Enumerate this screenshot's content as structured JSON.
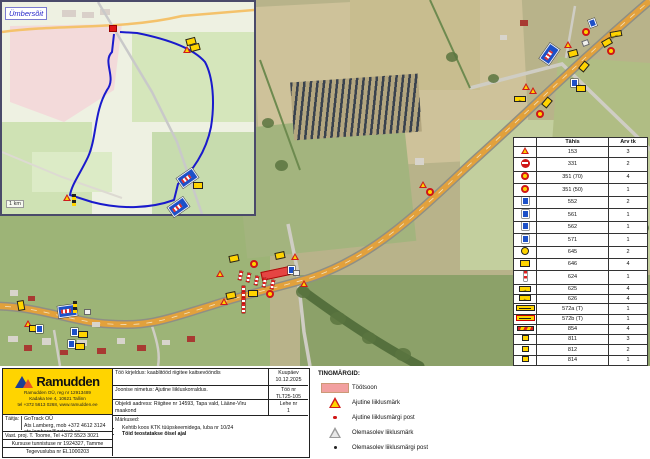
{
  "inset": {
    "label": "Ümbersõit",
    "scale": "1 km"
  },
  "legend_table": {
    "header": {
      "icon": "",
      "code": "Tähis",
      "qty": "Arv tk"
    },
    "rows": [
      {
        "icon": "warn",
        "code": "153",
        "qty": "3"
      },
      {
        "icon": "noentry",
        "code": "331",
        "qty": "2"
      },
      {
        "icon": "speed",
        "code": "351 (70)",
        "qty": "4"
      },
      {
        "icon": "speed",
        "code": "351 (50)",
        "qty": "1"
      },
      {
        "icon": "blueboard",
        "code": "552",
        "qty": "2"
      },
      {
        "icon": "blueboard",
        "code": "561",
        "qty": "1"
      },
      {
        "icon": "blueboard",
        "code": "562",
        "qty": "1"
      },
      {
        "icon": "blueboard",
        "code": "571",
        "qty": "1"
      },
      {
        "icon": "ycircle",
        "code": "645",
        "qty": "2"
      },
      {
        "icon": "yellowboard",
        "code": "646",
        "qty": "4"
      },
      {
        "icon": "delin",
        "code": "624",
        "qty": "1"
      },
      {
        "icon": "arrowR",
        "code": "625",
        "qty": "4"
      },
      {
        "icon": "arrowL",
        "code": "626",
        "qty": "4"
      },
      {
        "icon": "ylong",
        "code": "572a (T)",
        "qty": "1"
      },
      {
        "icon": "ylong2",
        "code": "572b (T)",
        "qty": "1"
      },
      {
        "icon": "fence",
        "code": "854",
        "qty": "4"
      },
      {
        "icon": "ysmall",
        "code": "811",
        "qty": "3"
      },
      {
        "icon": "ysmall",
        "code": "812",
        "qty": "2"
      },
      {
        "icon": "ysmall",
        "code": "814",
        "qty": "1"
      },
      {
        "icon": "ywide",
        "code": "784c Väljasõit\nehitusalalt",
        "qty": "2"
      },
      {
        "icon": "flagred",
        "code": "Post 1,3m",
        "qty": "27"
      },
      {
        "icon": "flagpink",
        "code": "Post 2,3m",
        "qty": "5"
      },
      {
        "icon": "flagblue",
        "code": "Post 3,3m",
        "qty": "2"
      },
      {
        "icon": "lamp",
        "code": "Punane lamp",
        "qty": "4"
      }
    ]
  },
  "symbols_legend": {
    "title": "TINGMÄRGID:",
    "items": [
      {
        "icon": "zone",
        "label": "Töötsoon"
      },
      {
        "icon": "tempsign",
        "label": "Ajutine liiklusmärk"
      },
      {
        "icon": "temppost",
        "label": "Ajutine liiklusmärgi post"
      },
      {
        "icon": "existsign",
        "label": "Olemasolev liiklusmärk"
      },
      {
        "icon": "existpost",
        "label": "Olemasolev liiklusmärgi post"
      }
    ]
  },
  "title_block": {
    "brand": "Ramudden",
    "brand_lines": [
      "Ramudden OÜ, reg nr 12913489",
      "Kadaka tee 4, 10621 Tallinn",
      "tel +372 5613 0268, www.ramudden.ee"
    ],
    "performer_label": "Täitja:",
    "performer_lines": [
      "GoTrack OÜ",
      "Ats Lamberg, mob +372 4612 3124",
      "ats.lamberg@gotrack.ee"
    ],
    "resp_line": "Vast. proj.  T. Toome, Tel +372 5523 3021",
    "cert_line": "Kursuse tunnistuse nr 1924327, Tamme",
    "license_line": "Tegevusluba nr EL1000203",
    "desc": "Töö kirjeldus: kaablitööd riigitee kaitsevööndis",
    "date_label": "Kuupäev",
    "date": "10.12.2025",
    "drawing": "Joonise nimetus: Ajutine liikluskorraldus.",
    "job_label": "Töö nr",
    "job": "TLT25-105",
    "address": "Objekti aadress: Riigitee nr 14593, Tapa vald, Lääne-Viru maakond",
    "sheet_label": "Lehe nr",
    "sheet": "1",
    "notes_title": "Märkused:",
    "notes": [
      {
        "text": "Kehtib koos KTK tüüpskeemidega, luba nr 10/24",
        "bold": false
      },
      {
        "text": "Töid teostatakse öisel ajal",
        "bold": true
      }
    ]
  },
  "map": {
    "colors": {
      "road": "#e2a13c",
      "workzone": "#e84040",
      "detour_route": "#1a1acc"
    },
    "markers": [
      {
        "t": "detour",
        "x": 540,
        "y": 48,
        "r": -55
      },
      {
        "t": "blueboard",
        "x": 589,
        "y": 19,
        "r": -20
      },
      {
        "t": "speed",
        "x": 582,
        "y": 28,
        "r": 0
      },
      {
        "t": "arrowR",
        "x": 610,
        "y": 31,
        "r": -10
      },
      {
        "t": "yellowboard",
        "x": 602,
        "y": 39,
        "r": -30
      },
      {
        "t": "speed",
        "x": 607,
        "y": 47,
        "r": 0
      },
      {
        "t": "warn",
        "x": 564,
        "y": 41,
        "r": 0
      },
      {
        "t": "whiteboard",
        "x": 582,
        "y": 40,
        "r": -20
      },
      {
        "t": "yellowboard",
        "x": 568,
        "y": 50,
        "r": -15
      },
      {
        "t": "yellowboard",
        "x": 579,
        "y": 63,
        "r": -50
      },
      {
        "t": "blueboard",
        "x": 571,
        "y": 79,
        "r": 0
      },
      {
        "t": "yellowboard",
        "x": 576,
        "y": 85,
        "r": 0
      },
      {
        "t": "warn",
        "x": 522,
        "y": 83,
        "r": 0
      },
      {
        "t": "warn",
        "x": 529,
        "y": 87,
        "r": 0
      },
      {
        "t": "arrowL",
        "x": 514,
        "y": 96,
        "r": 0
      },
      {
        "t": "yellowboard",
        "x": 542,
        "y": 99,
        "r": -50
      },
      {
        "t": "speed",
        "x": 536,
        "y": 110,
        "r": 0
      },
      {
        "t": "warn",
        "x": 419,
        "y": 181,
        "r": 0
      },
      {
        "t": "speed",
        "x": 426,
        "y": 188,
        "r": 0
      },
      {
        "t": "post",
        "x": 239,
        "y": 271,
        "r": 12
      },
      {
        "t": "post",
        "x": 247,
        "y": 273,
        "r": 12
      },
      {
        "t": "post",
        "x": 255,
        "y": 276,
        "r": 12
      },
      {
        "t": "post",
        "x": 263,
        "y": 278,
        "r": 12
      },
      {
        "t": "post",
        "x": 271,
        "y": 280,
        "r": 12
      },
      {
        "t": "post",
        "x": 242,
        "y": 286,
        "r": 0
      },
      {
        "t": "post",
        "x": 242,
        "y": 292,
        "r": 0
      },
      {
        "t": "post",
        "x": 242,
        "y": 298,
        "r": 0
      },
      {
        "t": "post",
        "x": 242,
        "y": 304,
        "r": 0
      },
      {
        "t": "warn",
        "x": 216,
        "y": 270,
        "r": 0
      },
      {
        "t": "warn",
        "x": 291,
        "y": 253,
        "r": 0
      },
      {
        "t": "warn",
        "x": 300,
        "y": 280,
        "r": 0
      },
      {
        "t": "warn",
        "x": 220,
        "y": 298,
        "r": 0
      },
      {
        "t": "speed",
        "x": 250,
        "y": 260,
        "r": 0
      },
      {
        "t": "speed",
        "x": 266,
        "y": 290,
        "r": 0
      },
      {
        "t": "yellowboard",
        "x": 229,
        "y": 255,
        "r": -12
      },
      {
        "t": "yellowboard",
        "x": 275,
        "y": 252,
        "r": -12
      },
      {
        "t": "yellowboard",
        "x": 226,
        "y": 292,
        "r": -12
      },
      {
        "t": "yellowboard",
        "x": 248,
        "y": 290,
        "r": 0
      },
      {
        "t": "blueboard",
        "x": 288,
        "y": 266,
        "r": 0
      },
      {
        "t": "whiteboard",
        "x": 293,
        "y": 270,
        "r": 0
      },
      {
        "t": "yellowboard",
        "x": 16,
        "y": 302,
        "r": 80
      },
      {
        "t": "warn",
        "x": 24,
        "y": 320,
        "r": 0
      },
      {
        "t": "yellowboard",
        "x": 29,
        "y": 325,
        "r": 0
      },
      {
        "t": "blueboard",
        "x": 36,
        "y": 325,
        "r": 0
      },
      {
        "t": "detour",
        "x": 58,
        "y": 305,
        "r": -8
      },
      {
        "t": "postB",
        "x": 73,
        "y": 301,
        "r": 0
      },
      {
        "t": "whiteboard",
        "x": 84,
        "y": 309,
        "r": 0
      },
      {
        "t": "blueboard",
        "x": 71,
        "y": 328,
        "r": 0
      },
      {
        "t": "yellowboard",
        "x": 78,
        "y": 331,
        "r": 0
      },
      {
        "t": "blueboard",
        "x": 68,
        "y": 340,
        "r": 0
      },
      {
        "t": "yellowboard",
        "x": 75,
        "y": 343,
        "r": 0
      },
      {
        "t": "yellowboard",
        "x": 186,
        "y": 38,
        "r": -15
      },
      {
        "t": "yellowboard",
        "x": 190,
        "y": 44,
        "r": -15
      },
      {
        "t": "warn",
        "x": 183,
        "y": 46,
        "r": 0
      },
      {
        "t": "detour",
        "x": 178,
        "y": 172,
        "r": -35
      },
      {
        "t": "detour",
        "x": 169,
        "y": 201,
        "r": -35
      },
      {
        "t": "yellowboard",
        "x": 193,
        "y": 182,
        "r": 0
      },
      {
        "t": "postB",
        "x": 72,
        "y": 194,
        "r": 0
      },
      {
        "t": "warn",
        "x": 63,
        "y": 194,
        "r": 0
      },
      {
        "t": "dotred",
        "x": 109,
        "y": 25,
        "r": 0
      }
    ]
  }
}
